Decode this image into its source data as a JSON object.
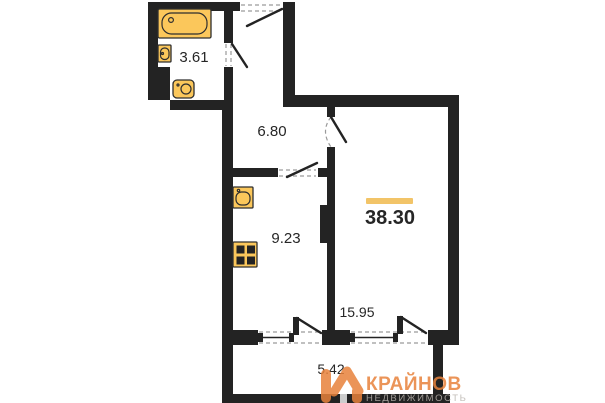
{
  "document": {
    "type": "apartment-floor-plan"
  },
  "rooms": {
    "bathroom": {
      "area": "3.61"
    },
    "hallway": {
      "area": "6.80"
    },
    "kitchen": {
      "area": "9.23"
    },
    "living": {
      "area": "15.95"
    },
    "balcony": {
      "area": "5.42"
    }
  },
  "total": {
    "area": "38.30"
  },
  "fixtures": [
    "bathtub-icon",
    "wall-sink-icon",
    "washing-machine-icon",
    "kitchen-sink-icon",
    "stove-icon"
  ],
  "logo": {
    "brand": "КРАЙНОВ",
    "subtitle": "НЕДВИЖИМОСТЬ"
  },
  "colors": {
    "wall": "#232323",
    "line": "#2e2e2e",
    "dash": "#9a9a9a",
    "label": "#262626",
    "fixture": "#FBC75B",
    "accent_line": "#F2C468",
    "brand_orange": "#E8823B",
    "subtitle_gray": "#B9B3AD"
  }
}
